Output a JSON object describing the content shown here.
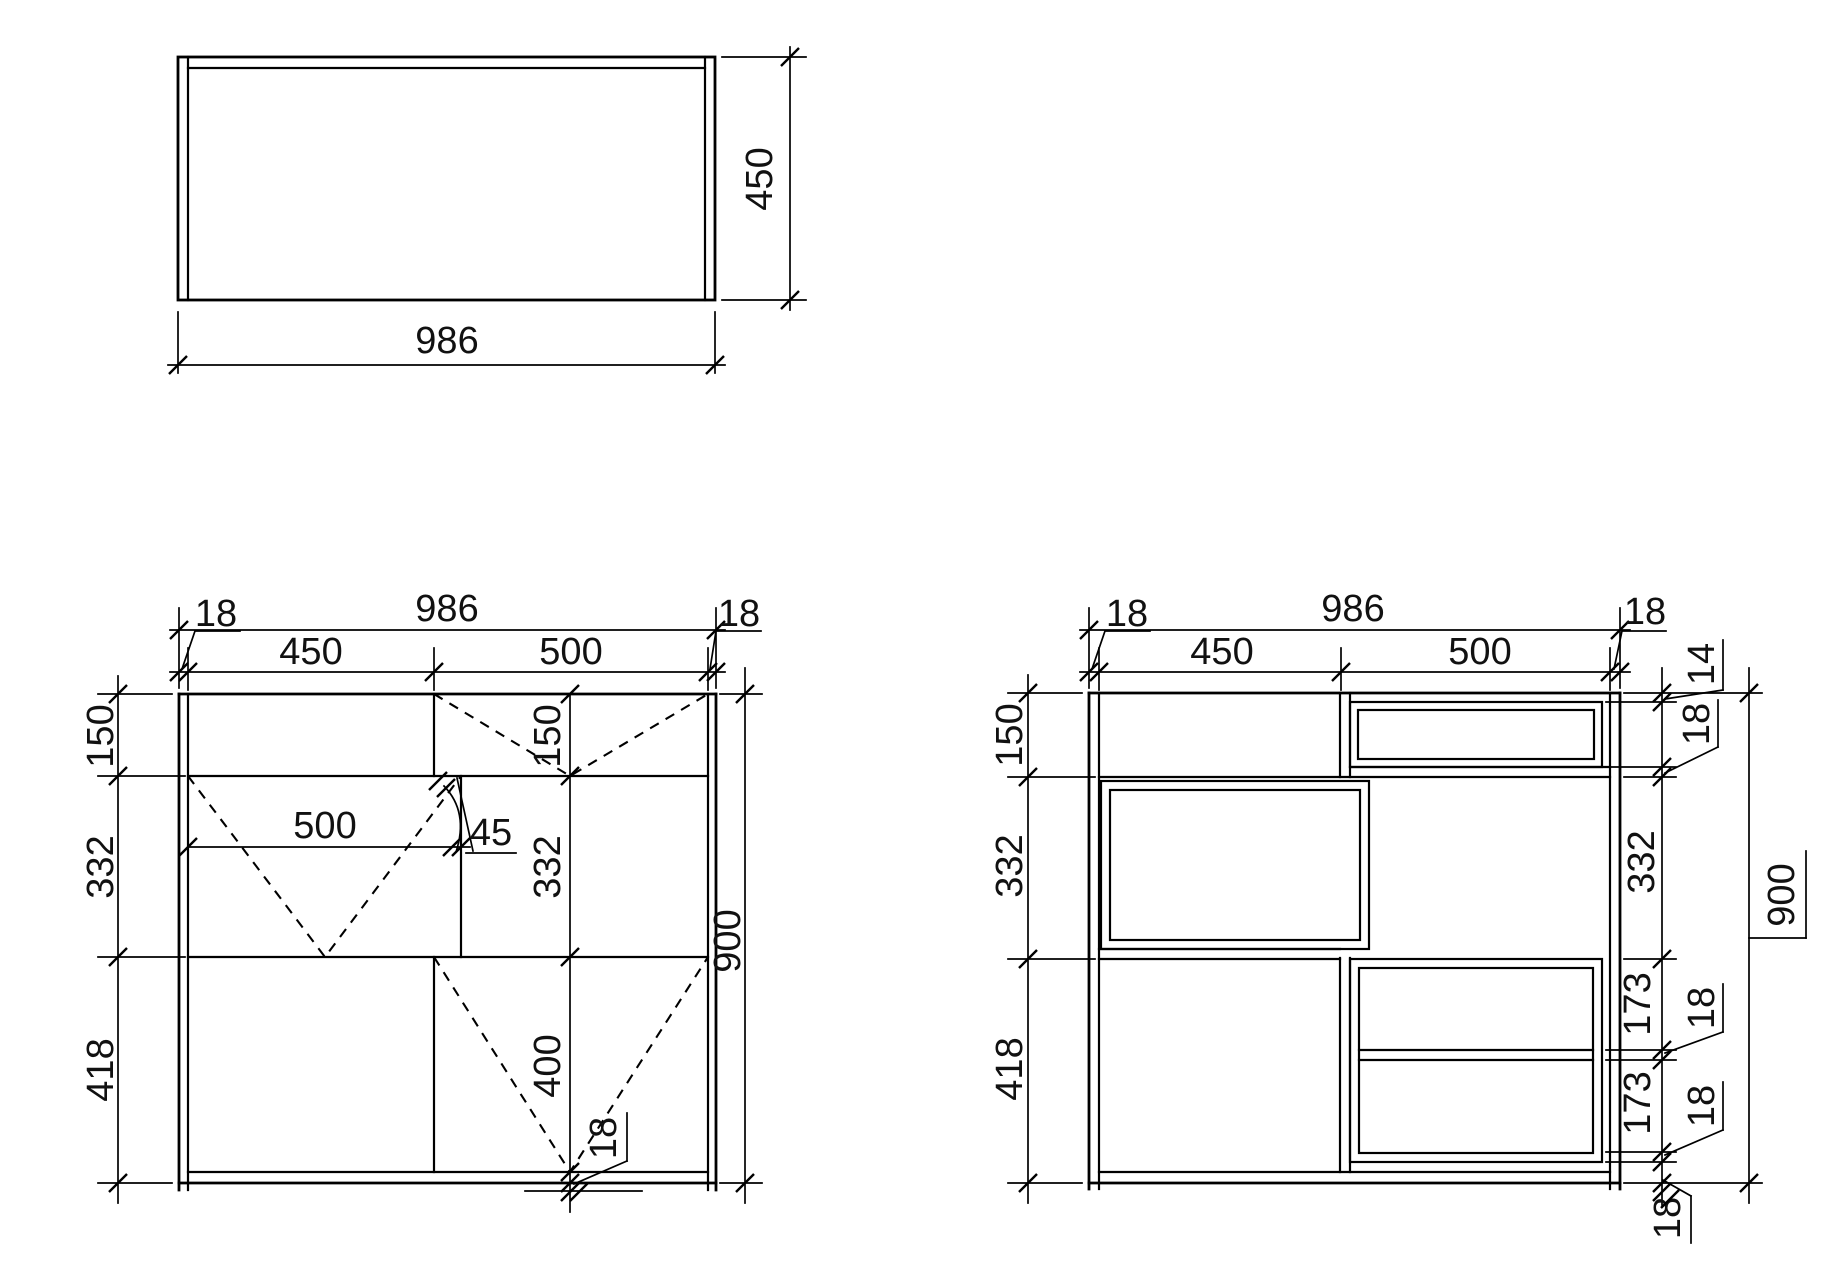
{
  "canvas": {
    "background": "#ffffff",
    "ink": "#000000"
  },
  "top_view": {
    "width": "986",
    "depth": "450"
  },
  "front_view": {
    "overall_width": "986",
    "left_panel": "18",
    "left_opening": "450",
    "right_opening": "500",
    "right_panel": "18",
    "top_row": "150",
    "middle_row": "332",
    "bottom_row": "418",
    "overall_height": "900",
    "inner_top_row": "150",
    "inner_middle_row": "332",
    "door_height": "400",
    "flap_width": "500",
    "flap_detail": "45",
    "bottom_panel": "18"
  },
  "section_view": {
    "overall_width": "986",
    "left_panel": "18",
    "left_opening": "450",
    "right_opening": "500",
    "right_panel": "18",
    "top_row": "150",
    "middle_row": "332",
    "bottom_row": "418",
    "overall_height": "900",
    "top_gap": "14",
    "drawer_shelf": "18",
    "middle_opening": "332",
    "shelf_space_upper": "173",
    "shelf_upper": "18",
    "shelf_space_lower": "173",
    "shelf_lower": "18",
    "bottom_panel": "18"
  }
}
